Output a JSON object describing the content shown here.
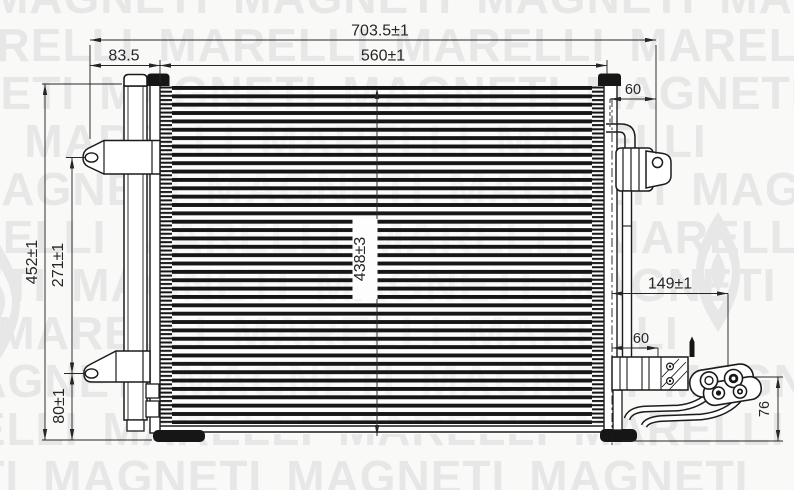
{
  "title": "Condenser technical drawing",
  "watermark": {
    "words": [
      "MAGNETI",
      "MARELLI"
    ],
    "color": "#e7e7e7"
  },
  "drawing": {
    "line_color": "#1b1b1b",
    "dim_color": "#262626"
  },
  "dimensions": {
    "overall_width": "703.5±1",
    "core_width": "560±1",
    "drier_offset": "83.5",
    "top_right_inset": "60",
    "overall_height": "452±1",
    "bracket_pitch": "271±1",
    "lower_bracket_offset": "80±1",
    "core_height": "438±3",
    "outlet_offset": "149±1",
    "lower_right_inset": "60",
    "outlet_drop": "76"
  }
}
